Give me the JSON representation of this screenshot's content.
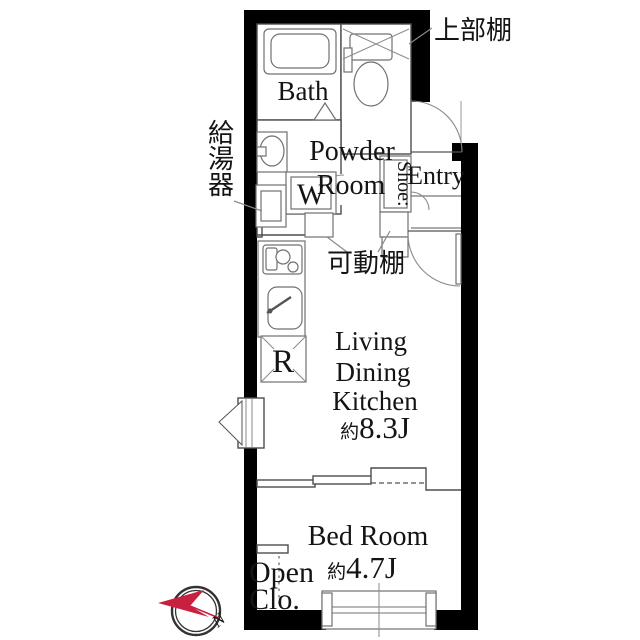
{
  "plan": {
    "bath": {
      "label": "Bath"
    },
    "powder_room": {
      "line1": "Powder",
      "line2": "Room"
    },
    "entry": {
      "label": "Entry"
    },
    "shoe_cabinet": {
      "label": "Shoe:"
    },
    "washing_machine": {
      "label": "W"
    },
    "refrigerator": {
      "label": "R"
    },
    "upper_shelf": {
      "label": "上部棚"
    },
    "water_heater": {
      "label": "給湯器"
    },
    "movable_shelf": {
      "label": "可動棚"
    },
    "ldk": {
      "line1": "Living",
      "line2": "Dining",
      "line3": "Kitchen",
      "area_prefix": "約",
      "area": "8.3J"
    },
    "bedroom": {
      "label": "Bed Room",
      "area_prefix": "約",
      "area": "4.7J"
    },
    "open_closet": {
      "line1": "Open",
      "line2": "Clo."
    },
    "compass": {
      "north_label": "N"
    }
  },
  "colors": {
    "wall": "#000000",
    "inner_line": "#4d4d4d",
    "compass_accent": "#c8203f",
    "background": "#ffffff"
  }
}
